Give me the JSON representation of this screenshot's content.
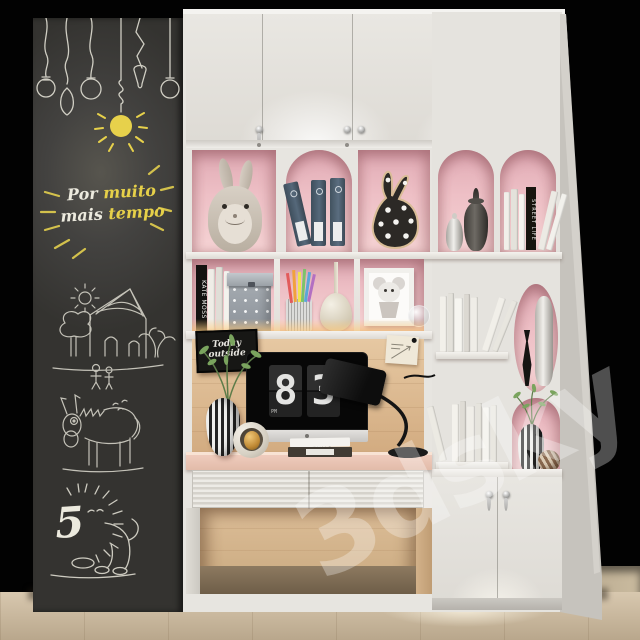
{
  "watermark": {
    "label": "3dsky"
  },
  "chalkboard": {
    "phrase_word1": "Por",
    "phrase_word2": "muito",
    "phrase_word3": "mais",
    "phrase_word4": "tempo",
    "lion_number": "5"
  },
  "desk_area": {
    "chalk_sign_line1": "Today",
    "chalk_sign_line2": "outside",
    "book_stack_spine": "LEWIS"
  },
  "imac": {
    "clock_hour": "8",
    "clock_minute": "3",
    "clock_meridiem": "PM"
  },
  "bookshelves": {
    "left_black_book_spine": "KATE MOSS",
    "right_black_book_spine": "STREET LIFE"
  },
  "palette": {
    "background": "#000000",
    "cabinet_white": "#e7e5e0",
    "niche_pink": "#edc2c8",
    "oak_wood": "#d8b78f",
    "desk_pink": "#f0cec2",
    "chalkboard_dark": "#3c3b37",
    "chalk_yellow": "#e6d049",
    "chalk_white": "#eae8dc",
    "led_glow": "#ffc98a",
    "binder_blue": "#4b5c69"
  }
}
